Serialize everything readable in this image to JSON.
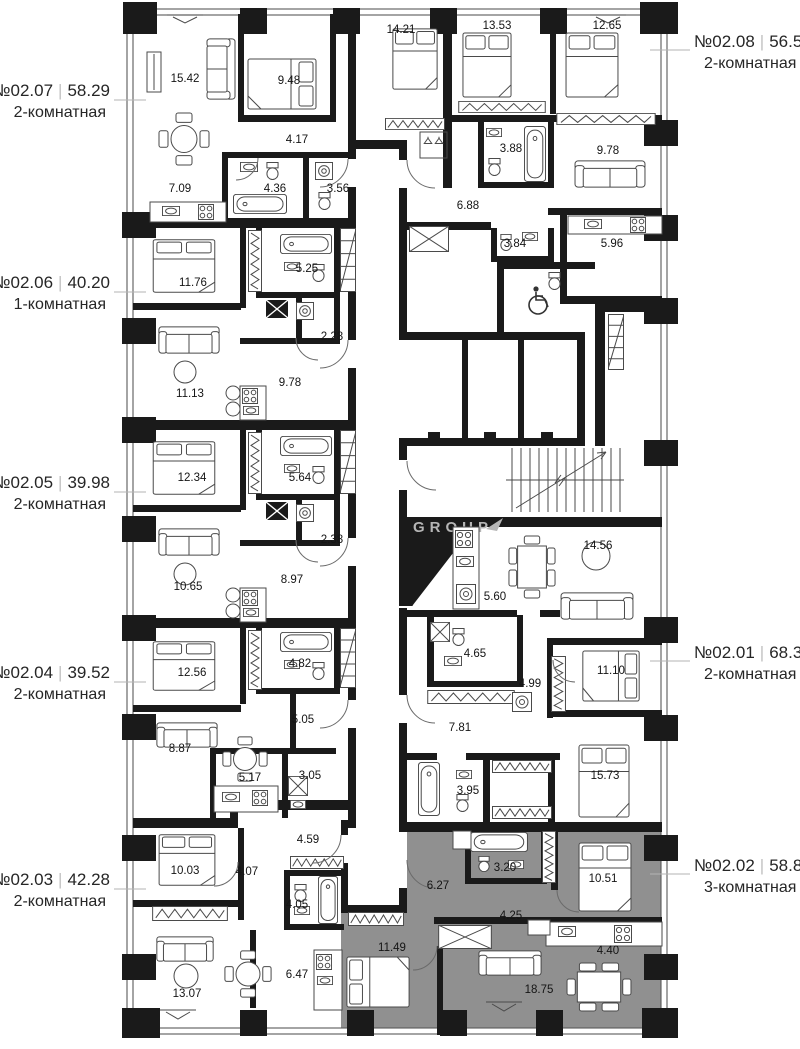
{
  "watermark": {
    "text": "GROUP"
  },
  "ui": {
    "separator": "|"
  },
  "colors": {
    "highlight": "#909090",
    "walls": "#1a1a1a",
    "background": "#ffffff"
  },
  "apartments": [
    {
      "number": "№02.07",
      "area": "58.29",
      "type": "2-комнатная",
      "side": "left",
      "highlighted": false,
      "rooms": [
        "15.42",
        "9.48",
        "14.21",
        "4.17",
        "7.09",
        "4.36",
        "3.56"
      ]
    },
    {
      "number": "№02.08",
      "area": "56.52",
      "type": "2-комнатная",
      "side": "right",
      "highlighted": false,
      "rooms": [
        "13.53",
        "12.65",
        "3.88",
        "9.78",
        "6.88",
        "3.84",
        "5.96"
      ]
    },
    {
      "number": "№02.06",
      "area": "40.20",
      "type": "1-комнатная",
      "side": "left",
      "highlighted": false,
      "rooms": [
        "11.76",
        "5.25",
        "2.28",
        "11.13",
        "9.78"
      ]
    },
    {
      "number": "№02.05",
      "area": "39.98",
      "type": "2-комнатная",
      "side": "left",
      "highlighted": false,
      "rooms": [
        "12.34",
        "5.64",
        "2.38",
        "10.65",
        "8.97"
      ]
    },
    {
      "number": "№02.04",
      "area": "39.52",
      "type": "2-комнатная",
      "side": "left",
      "highlighted": false,
      "rooms": [
        "12.56",
        "4.82",
        "5.05",
        "8.87",
        "5.17",
        "3.05"
      ]
    },
    {
      "number": "№02.03",
      "area": "42.28",
      "type": "2-комнатная",
      "side": "left",
      "highlighted": false,
      "rooms": [
        "10.03",
        "4.07",
        "4.59",
        "4.05",
        "13.07",
        "6.47"
      ]
    },
    {
      "number": "№02.01",
      "area": "68.39",
      "type": "2-комнатная",
      "side": "right",
      "highlighted": false,
      "rooms": [
        "14.56",
        "5.60",
        "4.65",
        "4.99",
        "11.10",
        "7.81",
        "15.73",
        "3.95"
      ]
    },
    {
      "number": "№02.02",
      "area": "58.87",
      "type": "3-комнатная",
      "side": "right",
      "highlighted": true,
      "rooms": [
        "6.27",
        "3.20",
        "10.51",
        "4.25",
        "11.49",
        "4.40",
        "18.75"
      ]
    }
  ]
}
